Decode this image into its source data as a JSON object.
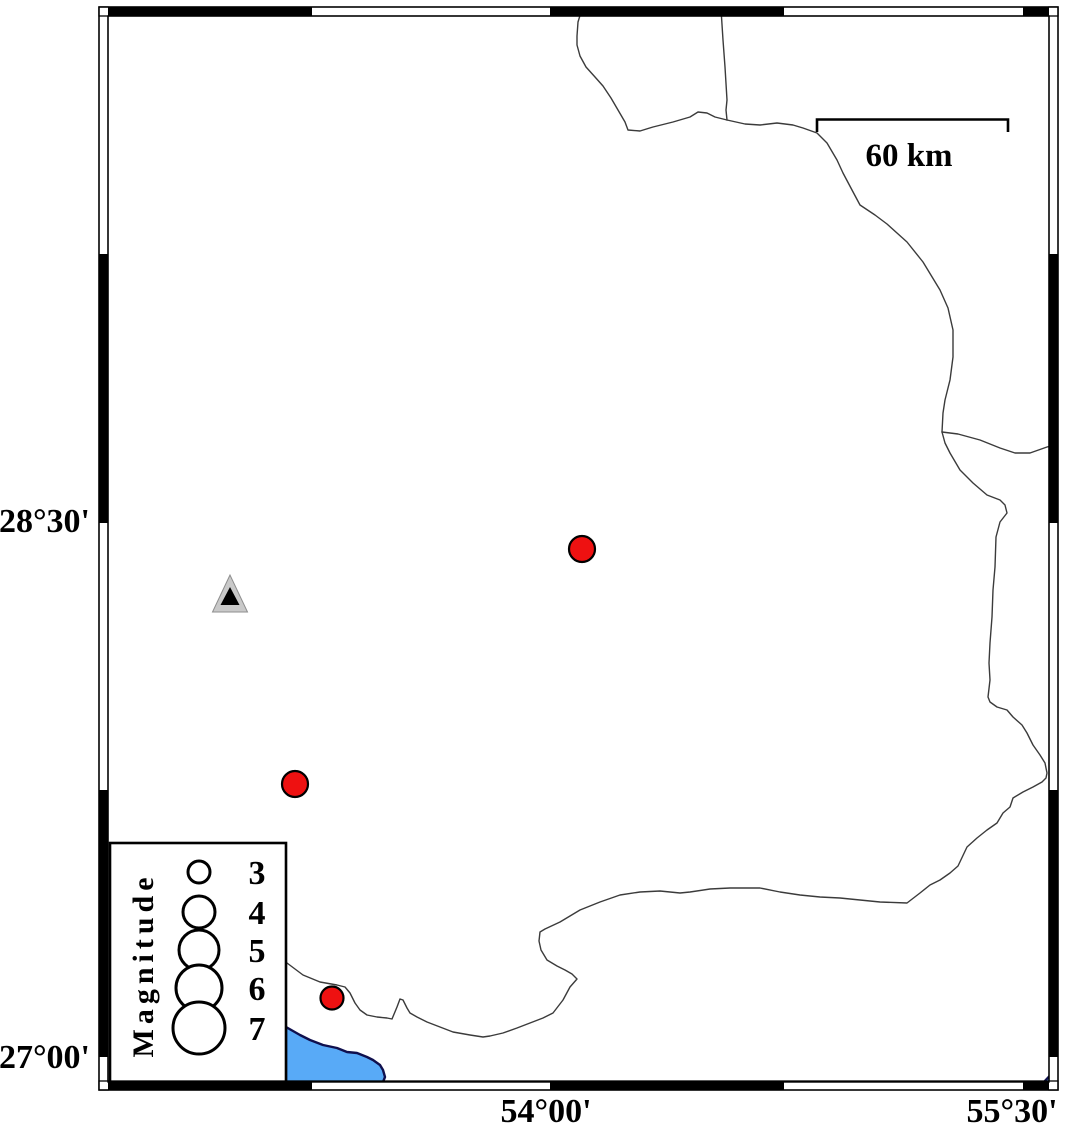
{
  "frame": {
    "left_labels": [
      {
        "text": "28°30'",
        "y": 521
      },
      {
        "text": "27°00'",
        "y": 1057
      }
    ],
    "bottom_labels": [
      {
        "text": "54°00'",
        "x": 546
      },
      {
        "text": "55°30'",
        "x": 1012
      }
    ]
  },
  "scale_bar": {
    "label": "60 km"
  },
  "legend": {
    "title": "Magnitude",
    "entries": [
      {
        "label": "3",
        "cy": 872,
        "r": 11
      },
      {
        "label": "4",
        "cy": 912,
        "r": 16
      },
      {
        "label": "5",
        "cy": 950,
        "r": 20
      },
      {
        "label": "6",
        "cy": 988,
        "r": 23
      },
      {
        "label": "7",
        "cy": 1028,
        "r": 26
      }
    ]
  },
  "markers": {
    "earthquakes": [
      {
        "x": 582,
        "y": 549,
        "r": 13
      },
      {
        "x": 295,
        "y": 784,
        "r": 13
      },
      {
        "x": 332,
        "y": 998,
        "r": 11.5
      }
    ],
    "station": {
      "x": 230,
      "y": 597
    }
  },
  "colors": {
    "earthquake_fill": "#ee1111",
    "water_fill": "#58aaf7",
    "water_outline": "#10104e",
    "station_outer_fill": "#c9c9c9",
    "station_inner_fill": "#000000",
    "boundary_line": "#3b3b3b"
  },
  "geometry": {
    "boundary_nw": "M582,9 L578,22 577,36 577,45 580,56 586,67 595,77 603,86 611,98 618,110 625,122 628,130 640,131 653,127 673,122 690,117 698,112 707,113 715,117 727,120",
    "boundary_n": "M721,9 L723,40 725,67 727,100 726,110 727,120",
    "boundary_e": "M727,120 L745,124 760,125 777,123 793,125 803,128 817,133 827,143 837,160 843,173 852,190 860,205 875,215 887,224 907,242 923,262 940,290 948,308 953,330 953,357 950,380 945,400 943,413 942,432",
    "boundary_branch": "M942,432 L958,434 980,440 1000,448 1015,453 1030,453 1047,447 1055,445",
    "boundary_se_coast": "M942,432 L945,443 950,453 960,470 973,483 987,495 1000,500 1005,505 1007,513 1000,522 996,537 995,567 993,590 992,617 990,643 989,663 990,680 988,697 990,702 997,707 1007,710 1013,717 1022,725 1027,733 1033,745 1040,755 1045,763 1047,773 1046,778 1042,782 1033,787 1023,792 1013,798 1010,807 1003,813 1000,818 997,823 987,830 977,838 967,847 958,866 950,873 940,880 930,885 920,893 907,903 880,902 860,900 840,898 820,897 800,895 780,892 760,888 730,888 710,889 690,892 680,893 670,892 660,891 640,892 620,895 600,902 580,910 560,922 545,929 540,932 539,941 541,950 547,960 557,966 565,970 572,974 577,979 570,987 563,1000 553,1013 543,1018 530,1023 517,1028 503,1033 490,1036 483,1037 470,1035 453,1032 440,1027 427,1022 417,1017 410,1013 407,1008 403,1000 400,999 397,1007 392,1019 387,1018 377,1017 367,1015 360,1010 355,1003 350,993 345,987 337,985 320,982 303,975 287,963",
    "water_main": "M286,1027 L300,1035 310,1040 323,1045 337,1048 347,1052 357,1053 367,1057 373,1060 380,1065 383,1070 385,1077 383,1082 286,1082 Z",
    "water_corner": "M1044,1082 L1057,1068 1057,1082 Z"
  }
}
